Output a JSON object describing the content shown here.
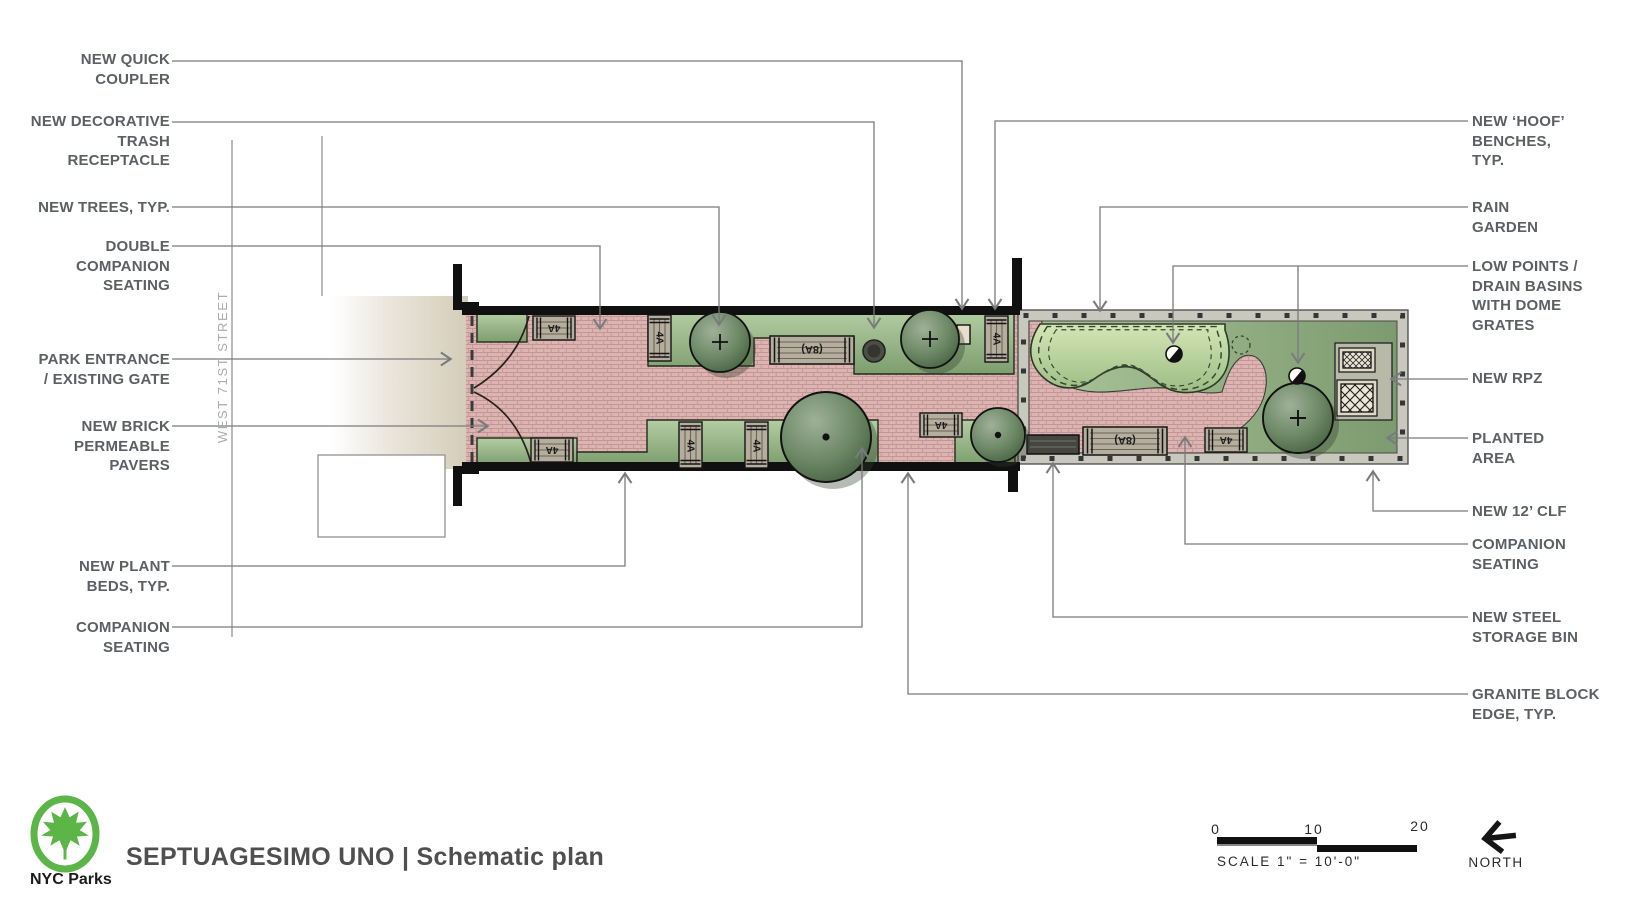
{
  "street_label": "WEST 71ST STREET",
  "callouts_left": [
    {
      "id": "new-quick-coupler",
      "text": "NEW QUICK\nCOUPLER"
    },
    {
      "id": "new-decorative-trash-receptacle",
      "text": "NEW DECORATIVE\nTRASH\nRECEPTACLE"
    },
    {
      "id": "new-trees",
      "text": "NEW  TREES, TYP."
    },
    {
      "id": "double-companion-seating",
      "text": "DOUBLE\nCOMPANION\nSEATING"
    },
    {
      "id": "park-entrance-existing-gate",
      "text": "PARK ENTRANCE\n/ EXISTING GATE"
    },
    {
      "id": "new-brick-permeable-pavers",
      "text": "NEW BRICK\nPERMEABLE\nPAVERS"
    },
    {
      "id": "new-plant-beds",
      "text": "NEW PLANT\nBEDS, TYP."
    },
    {
      "id": "companion-seating-left",
      "text": "COMPANION\nSEATING"
    }
  ],
  "callouts_right": [
    {
      "id": "new-hoof-benches",
      "text": "NEW ‘HOOF’\nBENCHES,\nTYP."
    },
    {
      "id": "rain-garden",
      "text": "RAIN\nGARDEN"
    },
    {
      "id": "low-points-drain-basins",
      "text": "LOW POINTS /\nDRAIN BASINS\nWITH DOME\nGRATES"
    },
    {
      "id": "new-rpz",
      "text": "NEW RPZ"
    },
    {
      "id": "planted-area",
      "text": "PLANTED\nAREA"
    },
    {
      "id": "new-12-clf",
      "text": "NEW 12’ CLF"
    },
    {
      "id": "companion-seating-right",
      "text": "COMPANION\nSEATING"
    },
    {
      "id": "new-steel-storage-bin",
      "text": "NEW STEEL\nSTORAGE BIN"
    },
    {
      "id": "granite-block-edge",
      "text": "GRANITE BLOCK\nEDGE, TYP."
    }
  ],
  "plan": {
    "benches": [
      "4A",
      "4A",
      "4A",
      "4A",
      "4A",
      "4A",
      "4A",
      "(8A)",
      "(8A)",
      "4A"
    ]
  },
  "title_block": {
    "agency": "NYC Parks",
    "park_name": "SEPTUAGESIMO UNO",
    "divider": " | ",
    "drawing_title": "Schematic plan"
  },
  "scale_bar": {
    "tick_0": "0",
    "tick_10": "10",
    "tick_20": "20",
    "caption": "SCALE  1\" = 10'-0\""
  },
  "north_label": "NORTH",
  "colors": {
    "accent_green": "#5cb547",
    "paver_pink": "#ddb3b1",
    "planting_green": "#8fae7e",
    "label_gray": "#5c6064"
  }
}
